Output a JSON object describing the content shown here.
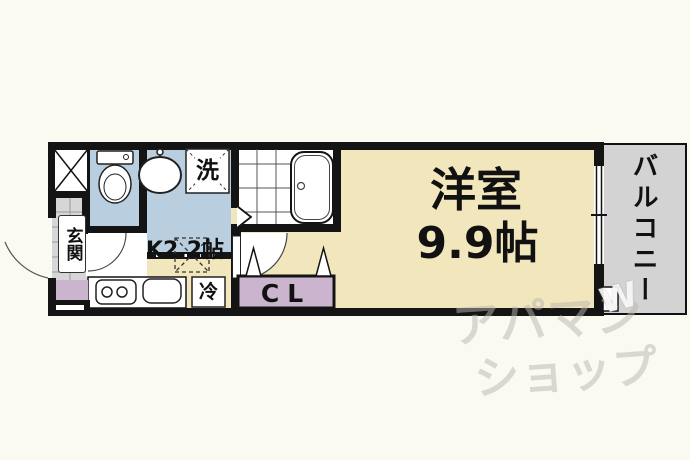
{
  "colors": {
    "background": "#FBFAF0",
    "wall": "#141414",
    "floor_cream": "#F2E6BD",
    "wet_area_blue": "#B9CFDF",
    "closet_purple": "#CBB4CD",
    "entrance_gray": "#D6D6D6",
    "balcony_gray": "#D3D3D3",
    "label_text": "#111111"
  },
  "rooms": {
    "kitchen": {
      "label": "K2.2帖"
    },
    "living_room": {
      "name": "洋室",
      "size": "9.9帖"
    },
    "closet": {
      "label": "CL"
    },
    "balcony": {
      "label": "バルコニー"
    },
    "entrance": {
      "label": "玄関"
    }
  },
  "fixtures": {
    "washing_machine": {
      "label": "洗"
    },
    "refrigerator": {
      "label": "冷"
    }
  },
  "watermark": {
    "line1": "アパマン",
    "line2": "ショップ",
    "mark": "W"
  }
}
